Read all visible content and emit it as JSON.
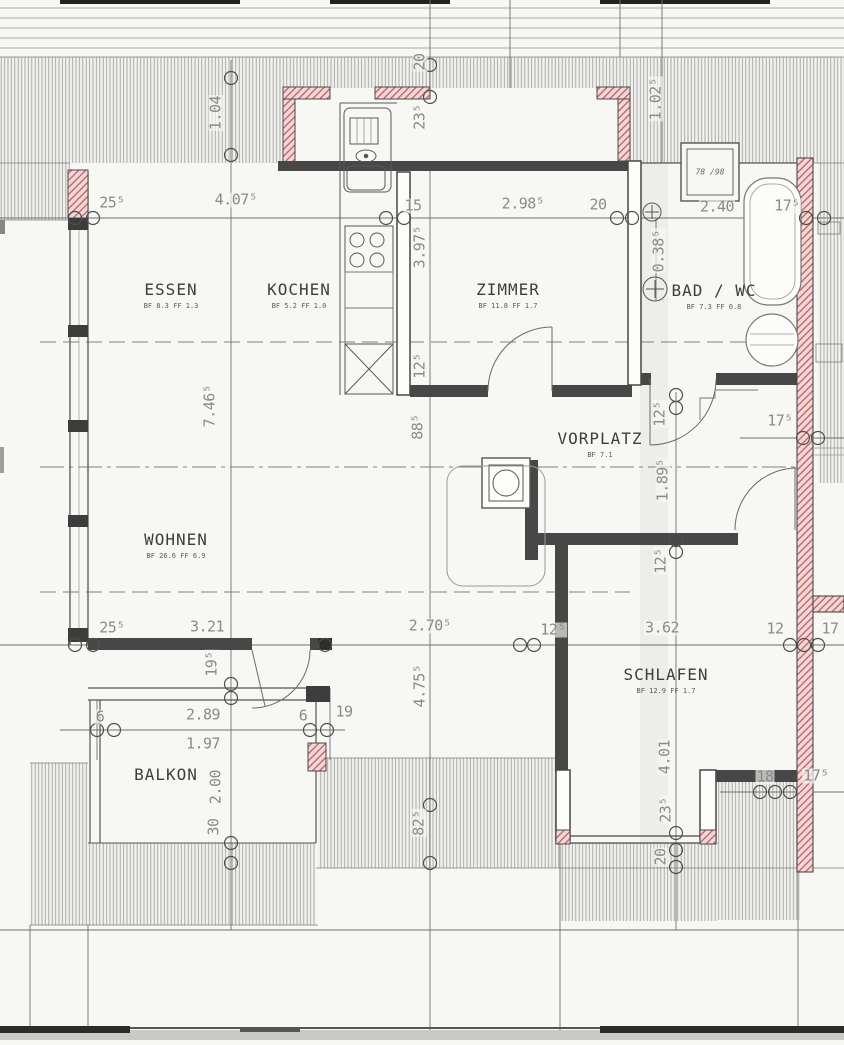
{
  "drawing_type": "floor-plan (Dachgeschoss / attic apartment)",
  "rooms": [
    {
      "name": "ESSEN",
      "info": "BF 8.3  FF 1.3"
    },
    {
      "name": "KOCHEN",
      "info": "BF 5.2  FF 1.0"
    },
    {
      "name": "ZIMMER",
      "info": "BF 11.8  FF 1.7"
    },
    {
      "name": "BAD / WC",
      "info": "BF 7.3  FF 0.8"
    },
    {
      "name": "VORPLATZ",
      "info": "BF 7.1"
    },
    {
      "name": "WOHNEN",
      "info": "BF 26.6  FF 6.9"
    },
    {
      "name": "SCHLAFEN",
      "info": "BF 12.9  FF 1.7"
    },
    {
      "name": "BALKON",
      "info": ""
    }
  ],
  "dims": {
    "top": [
      "25⁵",
      "4.07⁵",
      "15",
      "2.98⁵",
      "20",
      "2.40",
      "17⁵"
    ],
    "mid": [
      "25⁵",
      "3.21",
      "2.70⁵",
      "12⁵",
      "3.62",
      "12",
      "17"
    ],
    "balcony": [
      "6",
      "2.89",
      "6",
      "19",
      "1.97"
    ],
    "right": [
      "17⁵",
      "18",
      "17⁵"
    ],
    "vert": [
      "1.04",
      "20",
      "23⁵",
      "1.02⁵",
      "3.97⁵",
      "0.38⁵",
      "12⁵",
      "88⁵",
      "7.46⁵",
      "12⁵",
      "1.89⁵",
      "12⁵",
      "19⁵",
      "4.75⁵",
      "2.00",
      "30",
      "82⁵",
      "4.01",
      "23⁵",
      "20"
    ]
  },
  "annotations": {
    "roof_window": "78 /98"
  },
  "colors": {
    "paper": "#f7f7f4",
    "wall": "#474747",
    "masonry_hatch": "#c25c5c",
    "roof_hatch": "#9a9a9a",
    "dim_text": "#8a8a8a",
    "room_text": "#3e3e3e"
  }
}
